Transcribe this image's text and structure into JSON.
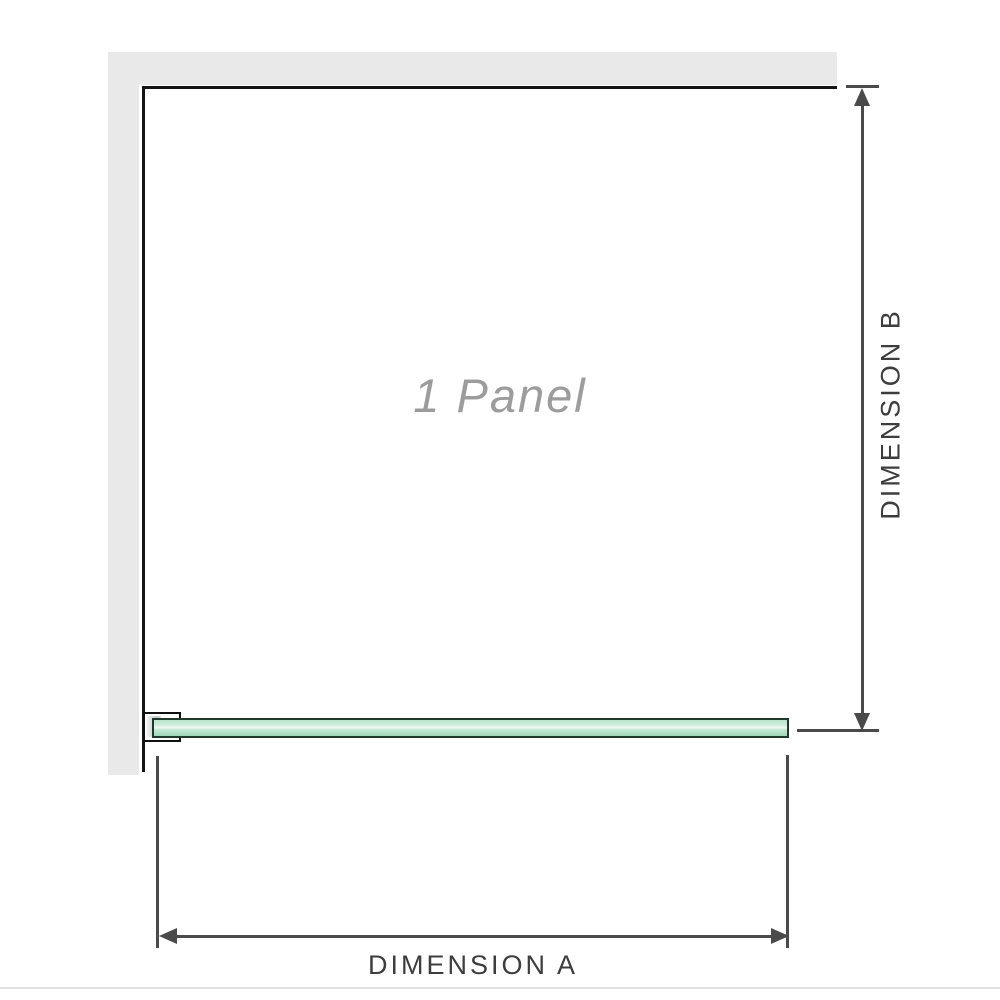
{
  "diagram": {
    "panel_label": "1 Panel",
    "dimension_a_label": "DIMENSION A",
    "dimension_b_label": "DIMENSION B",
    "colors": {
      "wall_gray": "#e9e9e9",
      "panel_outline_black": "#141414",
      "dimension_gray": "#4a4a4a",
      "panel_label_gray": "#9c9c9c",
      "glass_green": "#a0d6ba",
      "glass_highlight": "#eef8f2",
      "glass_border": "#1f3a2c",
      "divider_gray": "#e0e0e0"
    }
  }
}
